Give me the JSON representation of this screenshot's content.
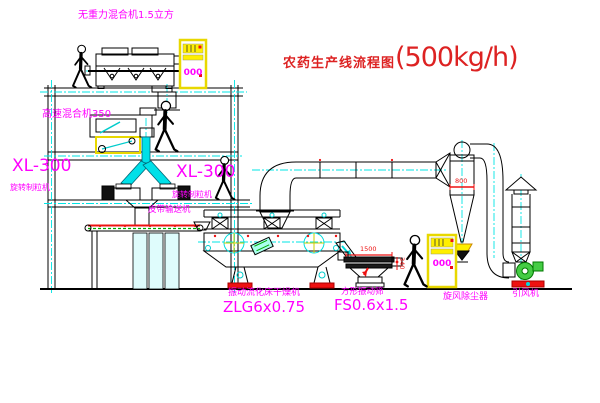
{
  "diagram": {
    "title": {
      "main": "农药生产线流程图",
      "capacity": "(500kg/h)"
    },
    "labels": {
      "gravity_mixer": "无重力混合机1.5立方",
      "high_speed_mixer": "高速混合机350",
      "granulator_left_model": "XL-300",
      "granulator_left_name": "旋转制粒机",
      "granulator_right_model": "XL-300",
      "granulator_right_name": "旋转制粒机",
      "belt_conveyor": "皮带输送机",
      "dryer_name": "振动流化床干燥机",
      "dryer_model": "ZLG6x0.75",
      "screen_name": "方形振动筛",
      "screen_model": "FS0.6x1.5",
      "cyclone": "旋风除尘器",
      "fan": "引风机"
    },
    "dimensions": {
      "cyclone_diameter": "800",
      "screen_length": "1500",
      "screen_height": "340"
    },
    "cabinets": {
      "roof_cabinet_text": "000",
      "ground_cabinet_text": "000"
    },
    "colors": {
      "label_magenta": "#ff00ff",
      "title_red": "#dd2222",
      "centerline_cyan": "#00e5e5",
      "cabinet_yellow": "#ffef00",
      "fan_green": "#33bb33",
      "dimension_red": "#ee1111"
    }
  }
}
